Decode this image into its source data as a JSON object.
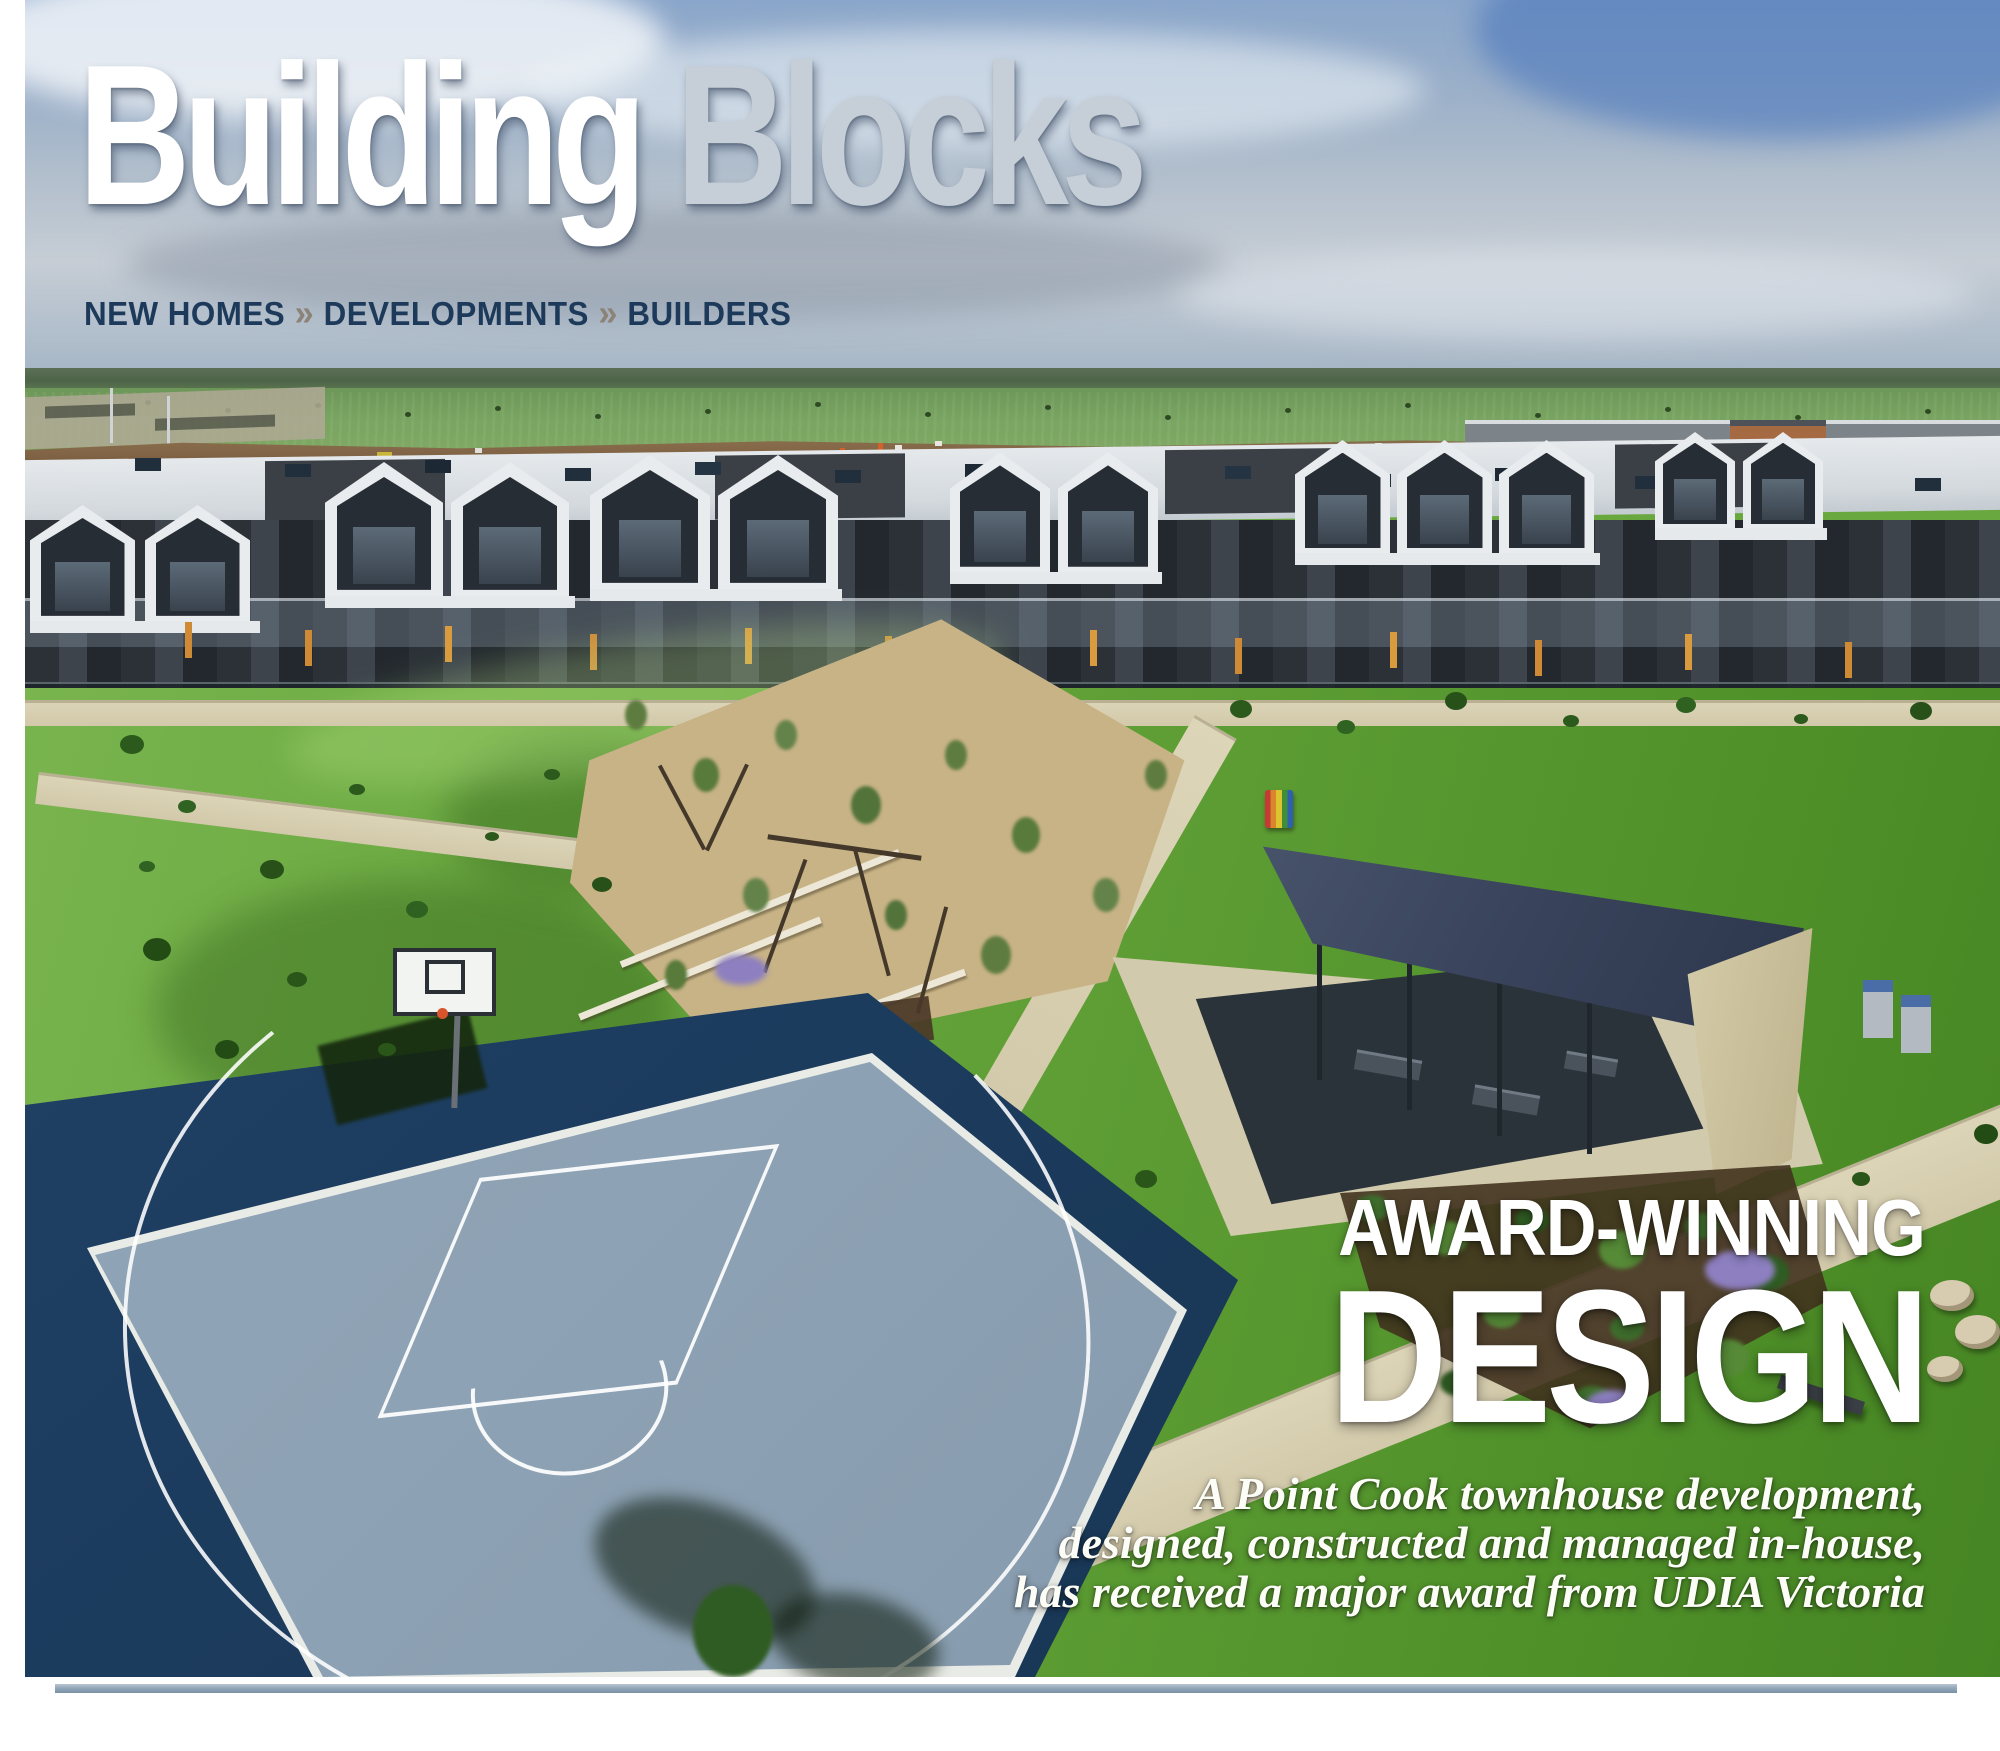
{
  "masthead": {
    "title_primary": "Building",
    "title_secondary": "Blocks",
    "separator": "»",
    "categories": [
      "NEW HOMES",
      "DEVELOPMENTS",
      "BUILDERS"
    ]
  },
  "overlay": {
    "kicker": "AWARD-WINNING",
    "headline": "DESIGN",
    "dek_lines": [
      "A Point Cook townhouse development,",
      "designed, constructed and managed in-house,",
      "has received a major award from UDIA Victoria"
    ]
  },
  "colors": {
    "masthead_primary": "#ffffff",
    "masthead_secondary": "#c6ced7",
    "category_text": "#1d3a5a",
    "chevron": "#8b8377",
    "court_navy": "#1d3d60",
    "court_surface": "#8da2b4",
    "rule_bar": "#93a7ba"
  }
}
